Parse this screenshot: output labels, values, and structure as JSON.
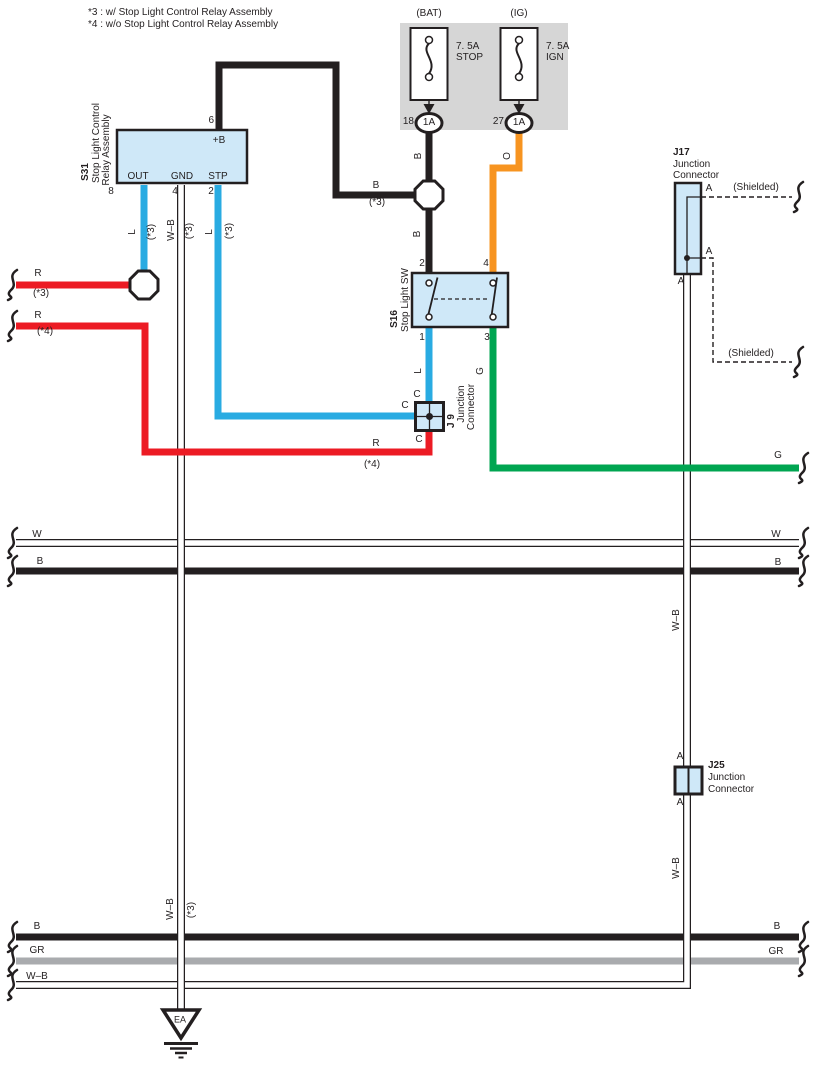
{
  "notes": {
    "n3": "*3 : w/ Stop Light Control Relay Assembly",
    "n4": "*4 : w/o Stop Light Control Relay Assembly"
  },
  "fuse_panel": {
    "bat": {
      "terminal": "(BAT)",
      "rating": "7. 5A",
      "circuit": "STOP",
      "pin": "18",
      "cavity": "1A"
    },
    "ig": {
      "terminal": "(IG)",
      "rating": "7. 5A",
      "circuit": "IGN",
      "pin": "27",
      "cavity": "1A"
    }
  },
  "s31": {
    "id": "S31",
    "name1": "Stop Light Control",
    "name2": "Relay Assembly",
    "plus_b": "+B",
    "out": "OUT",
    "gnd": "GND",
    "stp": "STP",
    "pin6": "6",
    "pin8": "8",
    "pin4": "4",
    "pin2": "2"
  },
  "s16": {
    "id": "S16",
    "name": "Stop Light SW",
    "pin2": "2",
    "pin4": "4",
    "pin1": "1",
    "pin3": "3"
  },
  "j9": {
    "id": "J 9",
    "name1": "Junction",
    "name2": "Connector",
    "c": "C"
  },
  "j17": {
    "id": "J17",
    "name1": "Junction",
    "name2": "Connector",
    "a": "A",
    "shielded": "(Shielded)"
  },
  "j25": {
    "id": "J25",
    "name1": "Junction",
    "name2": "Connector",
    "a": "A"
  },
  "labels": {
    "b": "B",
    "o": "O",
    "l": "L",
    "r": "R",
    "g": "G",
    "w": "W",
    "gr": "GR",
    "wb": "W–B",
    "v3": "(*3)",
    "v4": "(*4)"
  },
  "ground": {
    "id": "EA"
  },
  "colors": {
    "wire_black": "#231f20",
    "wire_orange": "#f79420",
    "wire_blue": "#29abe2",
    "wire_red": "#ec1b24",
    "wire_green": "#00a551",
    "wire_gray": "#a9abae",
    "box_fill": "#cfe8f8",
    "panel_fill": "#d6d6d6"
  }
}
